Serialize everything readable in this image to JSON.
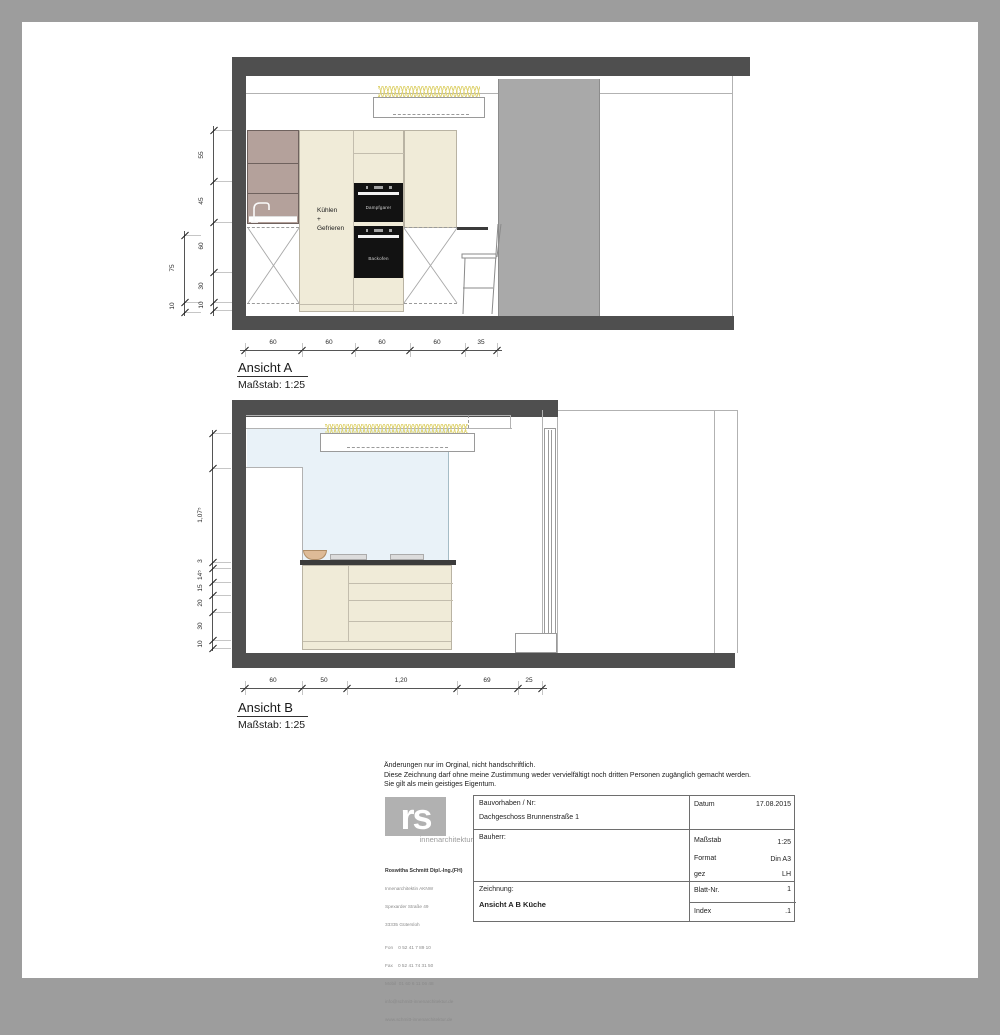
{
  "colors": {
    "frame": "#9d9d9d",
    "structure": "#4f4f4f",
    "wall_column": "#a9a9a9",
    "cabinet_cream": "#f0ebd8",
    "cabinet_mauve": "#b4a19b",
    "glass_blue": "#e9f2f8",
    "counter_dark": "#3b3b3b",
    "lights_yellow": "#ded26e",
    "bowl_tan": "#debb97",
    "logo_gray": "#b1b1b1"
  },
  "drawing_a": {
    "title": "Ansicht A",
    "scale": "Maßstab: 1:25",
    "label_line1": "Kühlen",
    "label_line2": "+",
    "label_line3": "Gefrieren",
    "appliance_top": "Dampfgarer",
    "appliance_bottom": "Backofen"
  },
  "drawing_b": {
    "title": "Ansicht B",
    "scale": "Maßstab: 1:25"
  },
  "dim_chains": [
    {
      "id": "a-left-outer",
      "dir": "v",
      "x": 184,
      "y1": 231,
      "y2": 316,
      "ext": 16,
      "ticks": [
        235,
        302,
        312
      ],
      "labels": [
        {
          "text": "75",
          "at": 268
        },
        {
          "text": "10",
          "at": 306
        }
      ]
    },
    {
      "id": "a-left-inner",
      "dir": "v",
      "x": 213,
      "y1": 126,
      "y2": 316,
      "ext": 18,
      "ticks": [
        130,
        181,
        222,
        272,
        302,
        310
      ],
      "labels": [
        {
          "text": "55",
          "at": 155
        },
        {
          "text": "45",
          "at": 201
        },
        {
          "text": "60",
          "at": 246
        },
        {
          "text": "30",
          "at": 286
        },
        {
          "text": "10",
          "at": 305
        }
      ]
    },
    {
      "id": "a-bottom",
      "dir": "h",
      "y": 350,
      "x1": 240,
      "x2": 502,
      "ticks": [
        245,
        302,
        355,
        410,
        465,
        497
      ],
      "labels": [
        {
          "text": "60",
          "at": 273
        },
        {
          "text": "60",
          "at": 329
        },
        {
          "text": "60",
          "at": 382
        },
        {
          "text": "60",
          "at": 437
        },
        {
          "text": "35",
          "at": 481
        }
      ]
    },
    {
      "id": "b-left",
      "dir": "v",
      "x": 212,
      "y1": 430,
      "y2": 651,
      "ext": 18,
      "ticks": [
        433,
        468,
        562,
        568,
        582,
        595,
        612,
        640,
        648
      ],
      "labels": [
        {
          "text": "1,07⁵",
          "at": 515
        },
        {
          "text": "3",
          "at": 561
        },
        {
          "text": "14⁵",
          "at": 575
        },
        {
          "text": "15",
          "at": 588
        },
        {
          "text": "20",
          "at": 603
        },
        {
          "text": "30",
          "at": 626
        },
        {
          "text": "10",
          "at": 644
        }
      ]
    },
    {
      "id": "b-bottom",
      "dir": "h",
      "y": 688,
      "x1": 240,
      "x2": 547,
      "ticks": [
        245,
        302,
        347,
        457,
        518,
        542
      ],
      "labels": [
        {
          "text": "60",
          "at": 273
        },
        {
          "text": "50",
          "at": 324
        },
        {
          "text": "1,20",
          "at": 401
        },
        {
          "text": "69",
          "at": 487
        },
        {
          "text": "25",
          "at": 529
        }
      ]
    }
  ],
  "disclaimer": {
    "line1": "Änderungen nur im Orginal, nicht handschriftlich.",
    "line2": "Diese Zeichnung darf ohne meine Zustimmung weder vervielfältigt noch dritten Personen zugänglich gemacht werden.",
    "line3": "Sie gilt als mein geistiges Eigentum."
  },
  "title_block": {
    "logo_text": "rs",
    "logo_subtitle": "innenarchitektur",
    "architect": {
      "name": "Roswitha Schmitt Dipl.-Ing.(FH)",
      "line1": "Innenarchitektin AKNW",
      "line2": "Spexarder Straße 49",
      "line3": "33335 Gütersloh",
      "fon": "Fon    0 52 41 7 89 10",
      "fax": "Fax    0 52 41 74 31 50",
      "mobil": "Mobil  01 60 6 11 06 48",
      "email": "info@schmitt-innenarchitektur.de",
      "web": "www.schmitt-innenarchitektur.de"
    },
    "project_label": "Bauvorhaben / Nr:",
    "project_value": "Dachgeschoss Brunnenstraße 1",
    "client_label": "Bauherr:",
    "drawing_label": "Zeichnung:",
    "drawing_value": "Ansicht A B Küche",
    "date_label": "Datum",
    "date_value": "17.08.2015",
    "scale_label": "Maßstab",
    "scale_value": "1:25",
    "format_label": "Format",
    "format_value": "Din A3",
    "gez_label": "gez",
    "gez_value": "LH",
    "sheet_label": "Blatt-Nr.",
    "sheet_value": "1",
    "index_label": "Index",
    "index_value": ".1"
  }
}
